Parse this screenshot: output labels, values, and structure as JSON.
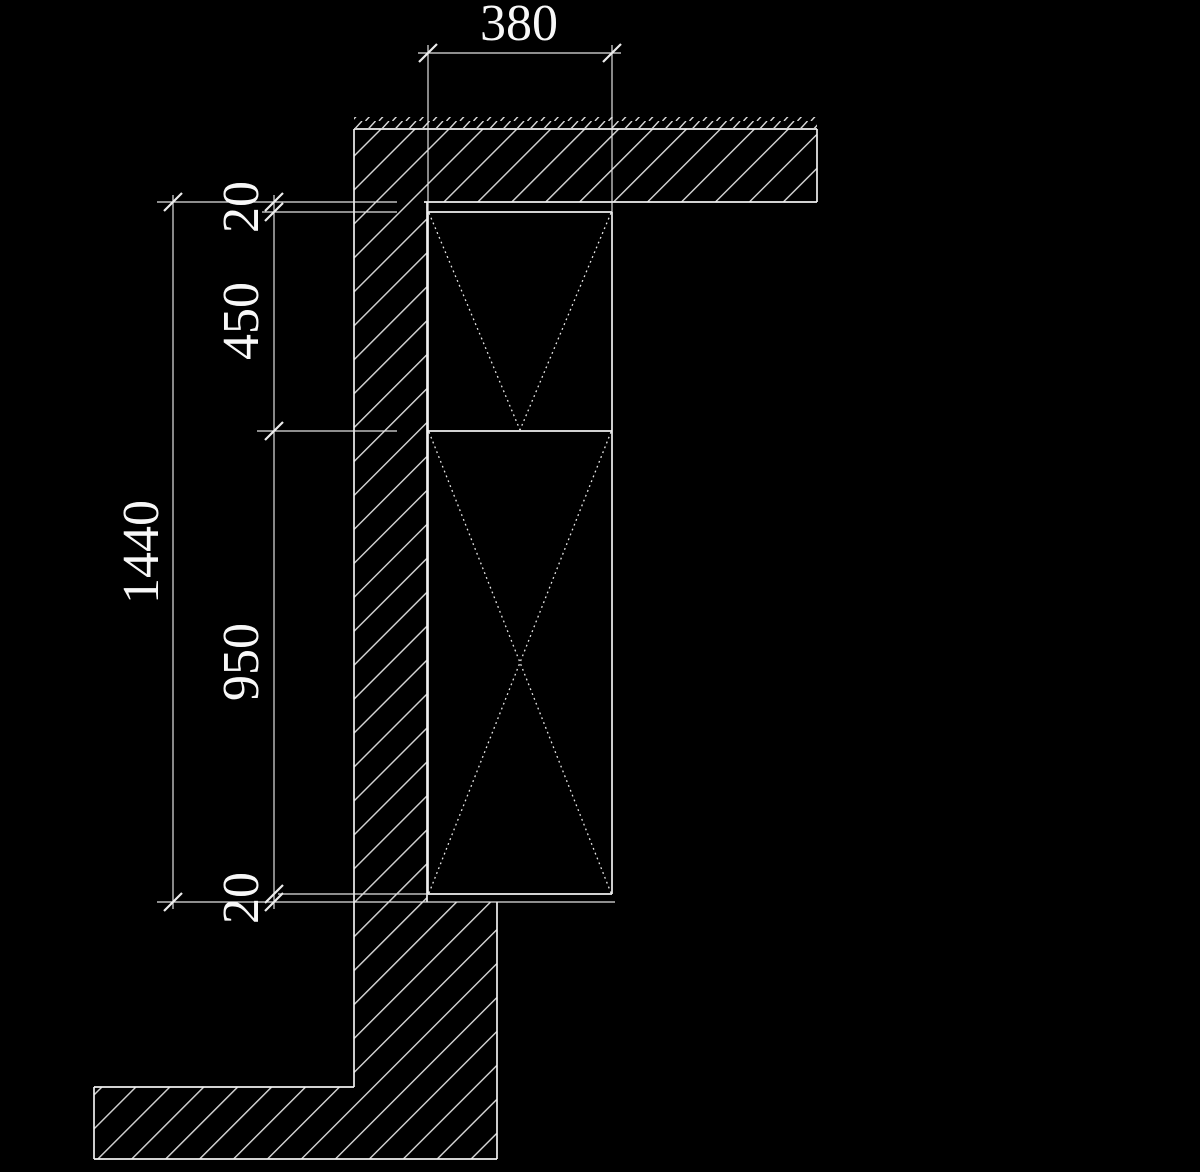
{
  "drawing": {
    "kind": "wall-section-detail",
    "colors": {
      "background": "#000000",
      "line": "#f0f0f0",
      "dim_line": "#e2e2e2",
      "text": "#f8f8f8"
    },
    "dims": {
      "frame_width": "380",
      "top_gap": "20",
      "upper_panel_height": "450",
      "overall_height": "1440",
      "lower_panel_height": "950",
      "bottom_gap": "20"
    }
  }
}
